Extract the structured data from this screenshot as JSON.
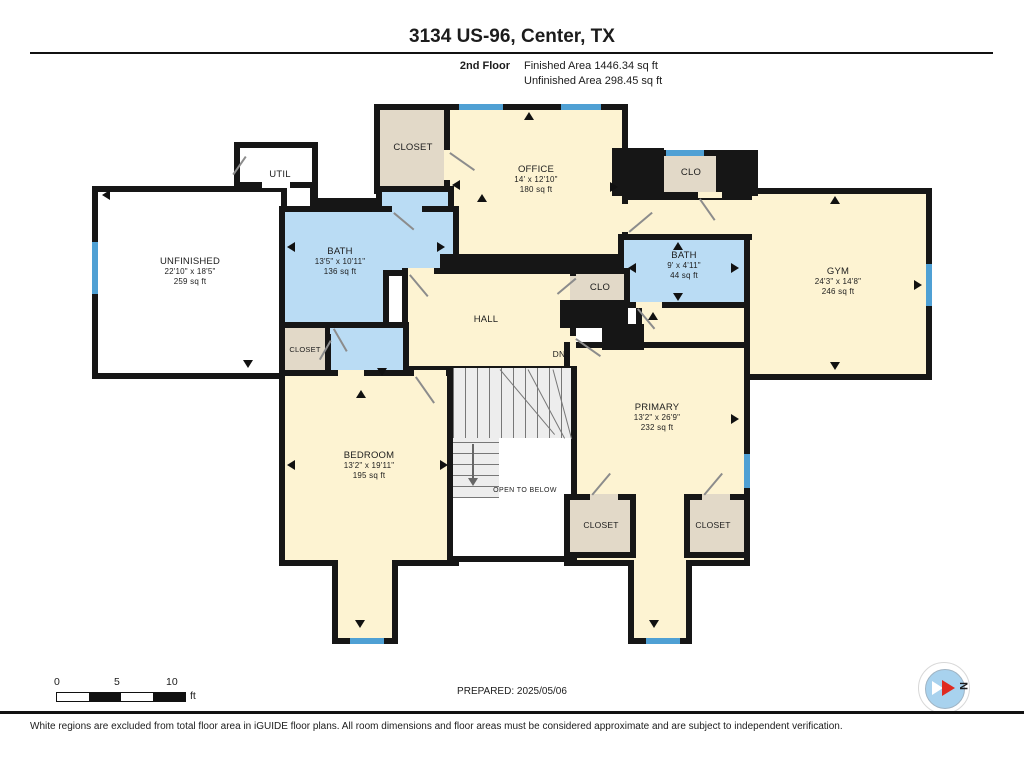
{
  "page": {
    "title": "3134 US-96, Center, TX",
    "floor": "2nd Floor",
    "finished": "Finished Area 1446.34 sq ft",
    "unfinished": "Unfinished Area 298.45 sq ft"
  },
  "rooms": {
    "util": {
      "name": "UTIL"
    },
    "unfinished": {
      "name": "UNFINISHED",
      "dims": "22'10\" x 18'5\"",
      "area": "259 sq ft"
    },
    "closet_top": {
      "name": "CLOSET"
    },
    "office": {
      "name": "OFFICE",
      "dims": "14' x 12'10\"",
      "area": "180 sq ft"
    },
    "clo_top": {
      "name": "CLO"
    },
    "gym": {
      "name": "GYM",
      "dims": "24'3\" x 14'8\"",
      "area": "246 sq ft"
    },
    "bath_main": {
      "name": "BATH",
      "dims": "13'5\" x 10'11\"",
      "area": "136 sq ft"
    },
    "bath_small": {
      "name": "BATH",
      "dims": "9' x 4'11\"",
      "area": "44 sq ft"
    },
    "clo_mid": {
      "name": "CLO"
    },
    "hall": {
      "name": "HALL"
    },
    "stairs": {
      "dn": "DN",
      "open_below": "OPEN TO BELOW"
    },
    "closet_left": {
      "name": "CLOSET"
    },
    "bedroom": {
      "name": "BEDROOM",
      "dims": "13'2\" x 19'11\"",
      "area": "195 sq ft"
    },
    "primary": {
      "name": "PRIMARY",
      "dims": "13'2\" x 26'9\"",
      "area": "232 sq ft"
    },
    "closet_p1": {
      "name": "CLOSET"
    },
    "closet_p2": {
      "name": "CLOSET"
    }
  },
  "footer": {
    "scale": {
      "zero": "0",
      "five": "5",
      "ten": "10",
      "unit": "ft"
    },
    "prepared": "PREPARED: 2025/05/06",
    "compass": "N",
    "disclaimer": "White regions are excluded from total floor area in iGUIDE floor plans. All room dimensions and floor areas must be considered approximate and are subject to independent verification."
  },
  "colors": {
    "wall": "#161616",
    "room_fill": "#fdf3d2",
    "closet_fill": "#e2d9c8",
    "bath_fill": "#badcf4",
    "window": "#4fa0d4",
    "unfinished_fill": "#ffffff"
  }
}
